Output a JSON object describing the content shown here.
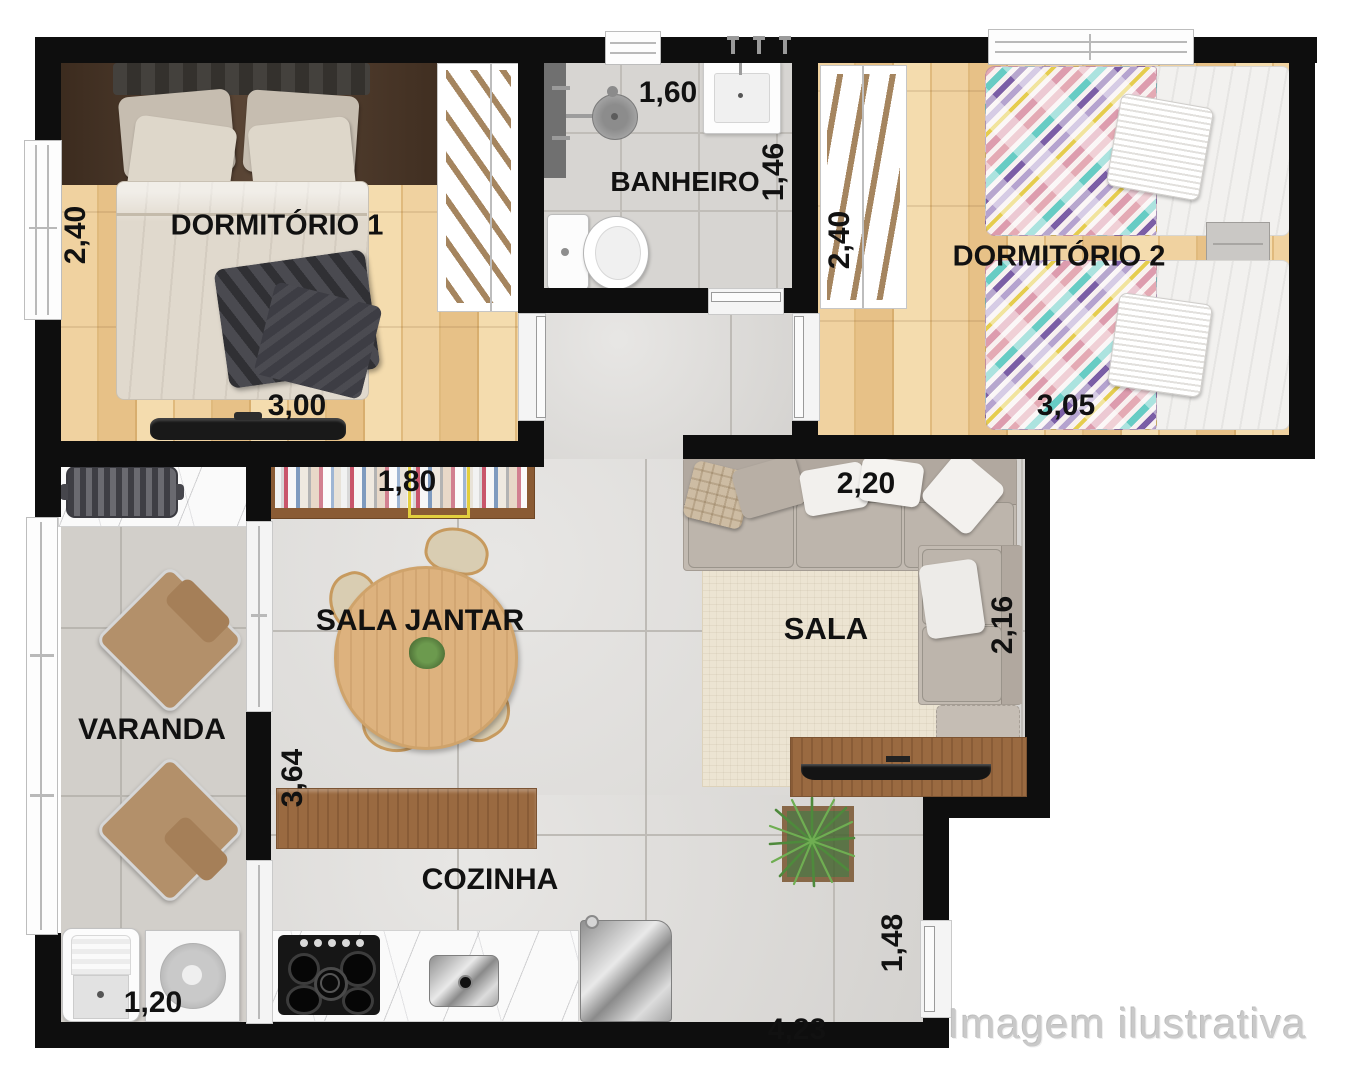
{
  "watermark": "Imagem ilustrativa",
  "rooms": {
    "dormitorio1": {
      "label": "DORMITÓRIO 1",
      "width": "3,00",
      "depth": "2,40"
    },
    "banheiro": {
      "label": "BANHEIRO",
      "width": "1,60",
      "depth": "1,46"
    },
    "dormitorio2": {
      "label": "DORMITÓRIO 2",
      "width": "3,05",
      "depth": "2,40"
    },
    "sala": {
      "label": "SALA",
      "width": "2,20",
      "depth": "2,16"
    },
    "sala_jantar": {
      "label": "SALA JANTAR",
      "shelf_width": "1,80",
      "depth": "3,64"
    },
    "varanda": {
      "label": "VARANDA"
    },
    "cozinha": {
      "label": "COZINHA",
      "width": "4,23",
      "service_width": "1,20",
      "entry_width": "1,48"
    }
  },
  "colors": {
    "wall": "#0e0e0e",
    "wood_floor": "#e9c68c",
    "tile_floor": "#dbd9d6",
    "label": "#111111",
    "watermark": "#c9c9c9",
    "accent_wood": "#9a6a41"
  }
}
